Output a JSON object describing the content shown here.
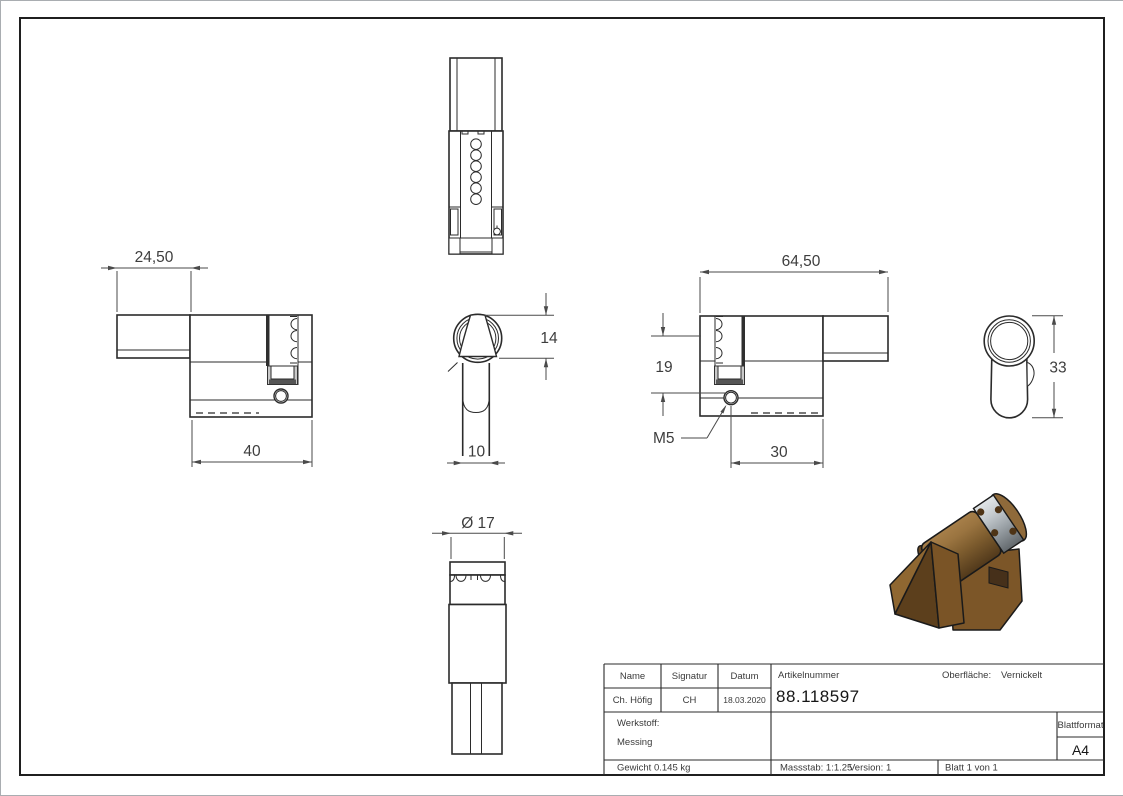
{
  "dims": {
    "knob_section_length": "24,50",
    "body_length": "40",
    "knob_height": "14",
    "stem_width": "10",
    "knob_diameter": "Ø 17",
    "total_length": "64,50",
    "pin_offset": "19",
    "screw_thread": "M5",
    "screw_offset": "30",
    "profile_height": "33"
  },
  "title_block": {
    "h_name": "Name",
    "h_signatur": "Signatur",
    "h_datum": "Datum",
    "h_artikelnummer": "Artikelnummer",
    "h_oberflaeche": "Oberfläche:",
    "h_werkstoff": "Werkstoff:",
    "h_blattformat": "Blattformat",
    "v_name": "Ch. Höfig",
    "v_signatur": "CH",
    "v_datum": "18.03.2020",
    "v_artikelnummer": "88.118597",
    "v_oberflaeche": "Vernickelt",
    "v_werkstoff": "Messing",
    "v_blattformat": "A4",
    "gewicht": "Gewicht 0.145 kg",
    "massstab": "Massstab: 1:1.25",
    "version": "Version: 1",
    "blatt": "Blatt 1 von 1"
  },
  "colors": {
    "line": "#2b2b2b",
    "dimension": "#4a4a4a",
    "brass": "#8a6434",
    "brass_light": "#9b7340",
    "brass_dark": "#5c3f1c",
    "silver": "#b9bfc3"
  }
}
